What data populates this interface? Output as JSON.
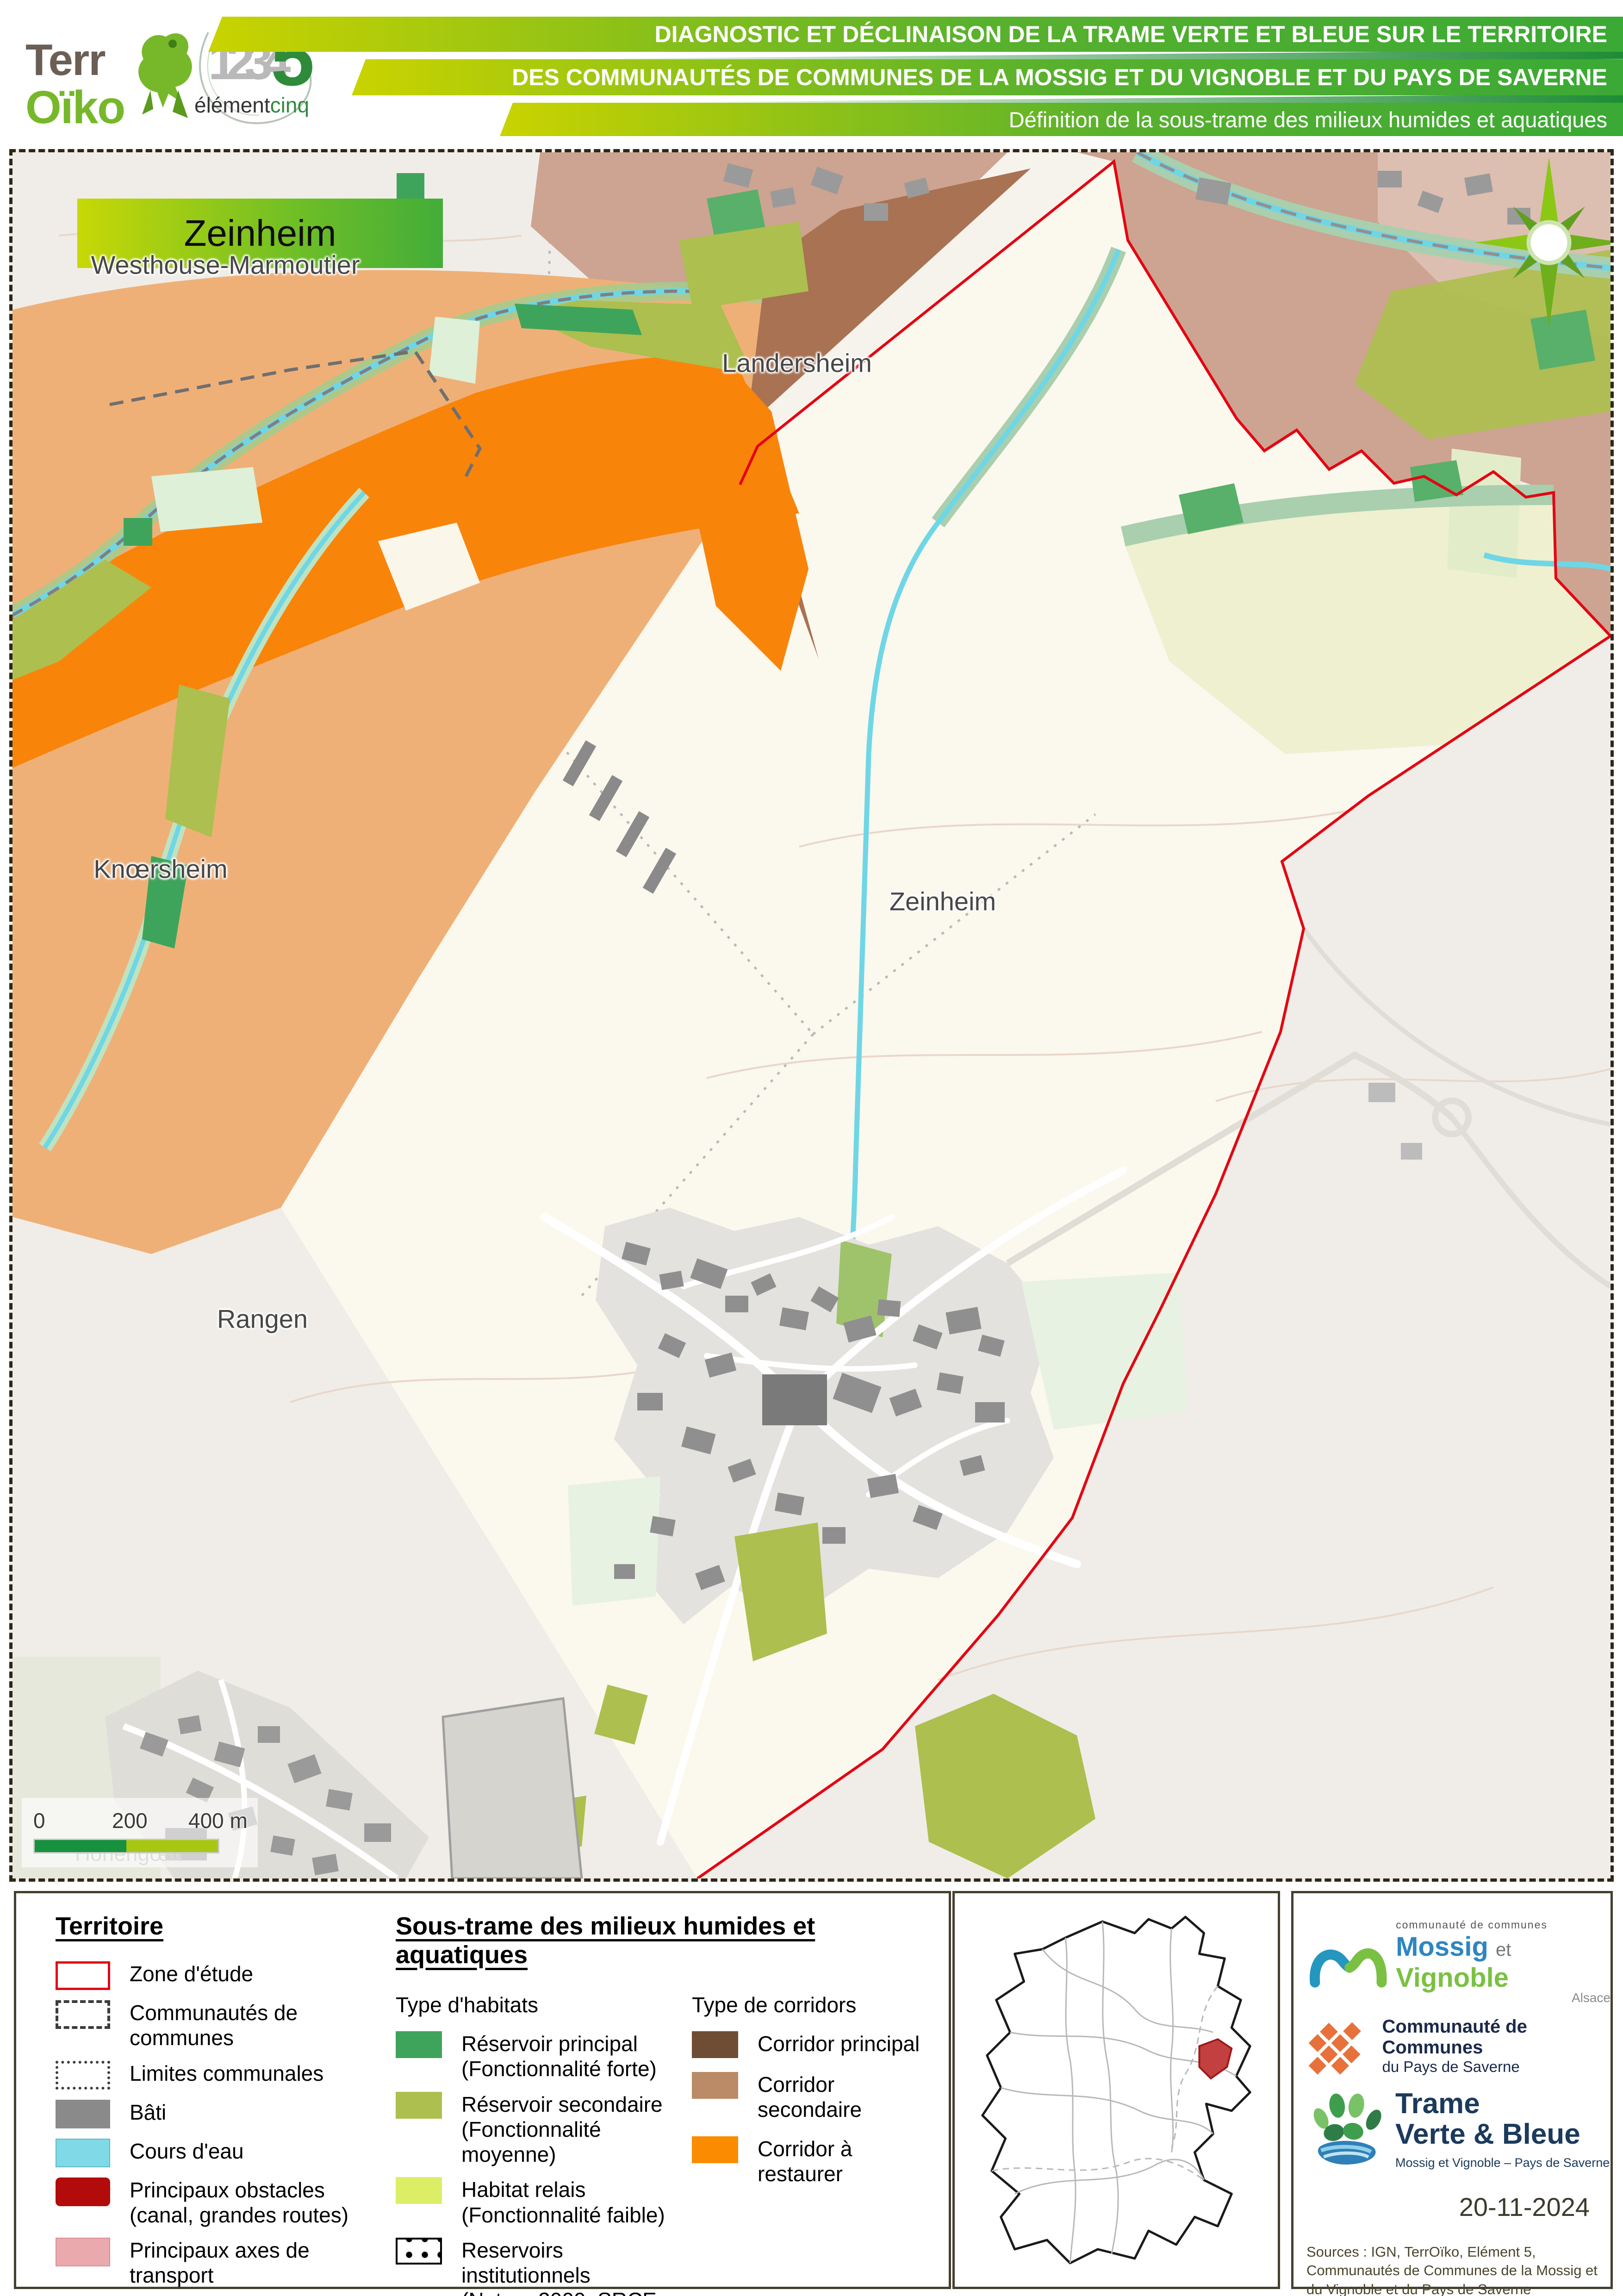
{
  "header": {
    "terroiko": {
      "part1": "Terr",
      "part2": "Oïko"
    },
    "element5": {
      "digits": "1234",
      "digit5": "5",
      "name_dark": "élément",
      "name_green": "cinq"
    },
    "banners": [
      {
        "label": "DIAGNOSTIC ET DÉCLINAISON DE LA TRAME VERTE ET BLEUE SUR LE TERRITOIRE"
      },
      {
        "label": "DES COMMUNAUTÉS DE COMMUNES DE LA MOSSIG ET DU VIGNOBLE ET DU PAYS DE SAVERNE"
      },
      {
        "label": "Définition de la sous-trame des milieux humides et aquatiques"
      }
    ]
  },
  "map": {
    "title": "Zeinheim",
    "labels": {
      "westhouse": "Westhouse-Marmoutier",
      "landersheim": "Landersheim",
      "knoersheim": "Knœrsheim",
      "zeinheim": "Zeinheim",
      "rangen": "Rangen",
      "hohengoeft": "Hohengœft"
    },
    "scalebar": {
      "zero": "0",
      "mid": "200",
      "end": "400 m"
    },
    "colors": {
      "zone_border": "#e30613",
      "corridor_principal": "#a87253",
      "corridor_secondaire": "#efb078",
      "corridor_restaurer": "#f9840a",
      "reservoir_principal": "#3fa45b",
      "reservoir_secondaire": "#adbf4e",
      "habitat_relais": "#eef0d0",
      "cours_eau": "#6fd6e6",
      "bati": "#8f8f8f"
    }
  },
  "legend": {
    "territoire": {
      "title": "Territoire",
      "items": [
        {
          "label": "Zone d'étude",
          "color": "#e30613"
        },
        {
          "label": "Communautés de communes",
          "color": "#3c3c3c"
        },
        {
          "label": "Limites communales",
          "color": "#3c3c3c"
        },
        {
          "label": "Bâti",
          "color": "#8a8a8a"
        },
        {
          "label": "Cours d'eau",
          "color": "#7fd9e6"
        },
        {
          "label": "Principaux obstacles",
          "sub": "(canal, grandes routes)",
          "color": "#b30b0b"
        },
        {
          "label": "Principaux axes de transport",
          "color": "#e9a9ad"
        }
      ]
    },
    "soustrame": {
      "title": "Sous-trame des milieux humides et aquatiques",
      "habitats": {
        "title": "Type d'habitats",
        "items": [
          {
            "label": "Réservoir principal",
            "sub": "(Fonctionnalité forte)",
            "color": "#3fa45b"
          },
          {
            "label": "Réservoir secondaire",
            "sub": "(Fonctionnalité moyenne)",
            "color": "#adbf4e"
          },
          {
            "label": "Habitat relais",
            "sub": "(Fonctionnalité faible)",
            "color": "#dcee66"
          },
          {
            "label": "Reservoirs institutionnels",
            "sub": "(Natura 2000, SRCE, ...)",
            "color": "#000000"
          }
        ]
      },
      "corridors": {
        "title": "Type de corridors",
        "items": [
          {
            "label": "Corridor principal",
            "color": "#6f4d34"
          },
          {
            "label": "Corridor secondaire",
            "color": "#bb8a66"
          },
          {
            "label": "Corridor à restaurer",
            "color": "#fb8b00"
          }
        ]
      }
    }
  },
  "credits": {
    "mossig": {
      "small": "communauté de communes",
      "name1": "Mossig",
      "conj": "et",
      "name2": "Vignoble",
      "region": "Alsace"
    },
    "saverne": {
      "line1": "Communauté de Communes",
      "line2": "du Pays de Saverne"
    },
    "tvb": {
      "line1": "Trame",
      "line2": "Verte & Bleue",
      "subtitle": "Mossig et Vignoble – Pays de Saverne"
    },
    "date": "20-11-2024",
    "sources": "Sources : IGN, TerrOïko, Elément 5, Communautés de Communes de la Mossig et du Vignoble et du Pays de Saverne"
  }
}
